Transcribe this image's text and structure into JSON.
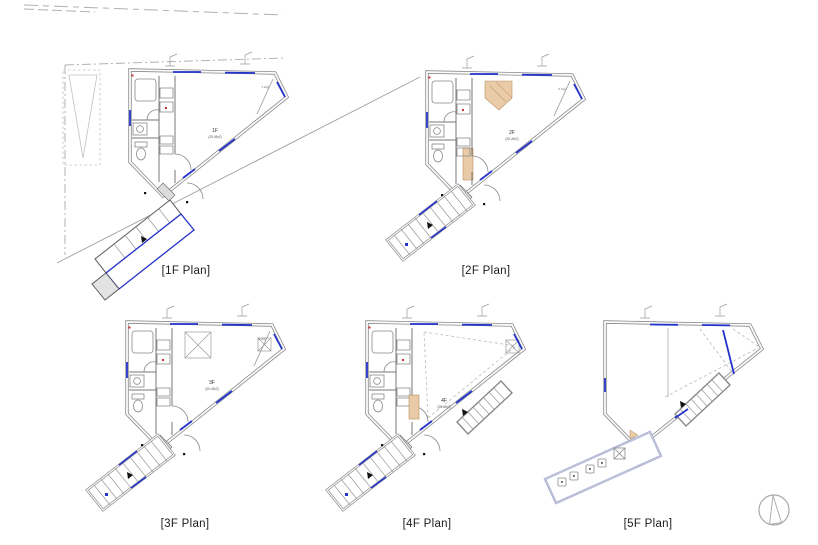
{
  "sheet": {
    "type": "architectural-floor-plans",
    "floors_shown": 5
  },
  "plans": [
    {
      "label": "[1F Plan]",
      "room_label": "1F",
      "room_area": "(25.45㎡)",
      "corner_label": "7.2㎡"
    },
    {
      "label": "[2F Plan]",
      "room_label": "2F",
      "room_area": "(25.45㎡)",
      "corner_label": "2.3㎡"
    },
    {
      "label": "[3F Plan]",
      "room_label": "3F",
      "room_area": "(25.45㎡)",
      "corner_label": "2.3㎡"
    },
    {
      "label": "[4F Plan]",
      "room_label": "4F",
      "room_area": "(25.45㎡)",
      "corner_label": ""
    },
    {
      "label": "[5F Plan]",
      "room_label": "",
      "room_area": "",
      "corner_label": ""
    }
  ],
  "colors": {
    "window_blue": "#2433cc",
    "terrace_periwinkle": "#98a0d8",
    "wall_gray": "#8a8a8a",
    "line_dark": "#555555",
    "tan_accent": "#e9cba8",
    "red_mark": "#cc3333",
    "site_line_gray": "#aaaaaa"
  },
  "icons": {
    "north_arrow": "north-arrow"
  }
}
